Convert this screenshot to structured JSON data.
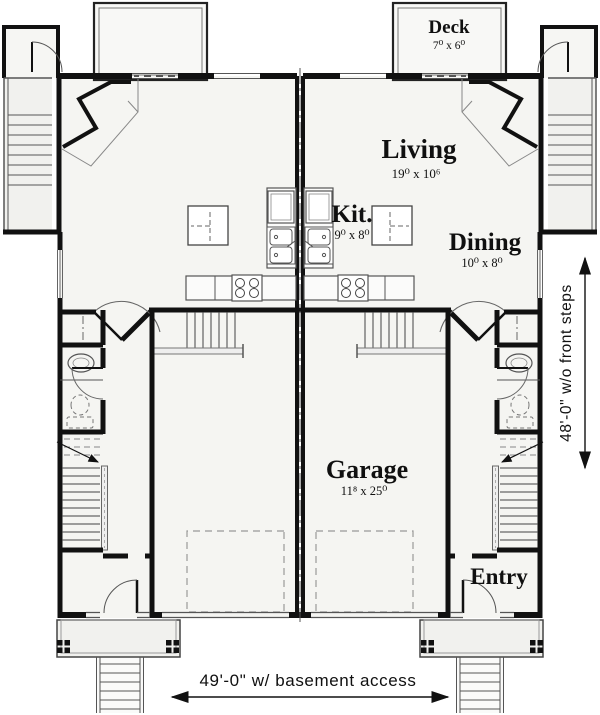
{
  "plan": {
    "rooms": {
      "deck": {
        "name": "Deck",
        "dims": "7⁰ x 6⁰"
      },
      "living": {
        "name": "Living",
        "dims": "19⁰ x 10⁶"
      },
      "kitchen": {
        "name": "Kit.",
        "dims": "9⁰ x 8⁰"
      },
      "dining": {
        "name": "Dining",
        "dims": "10⁰ x 8⁰"
      },
      "garage": {
        "name": "Garage",
        "dims": "11⁸ x 25⁰"
      },
      "entry": {
        "name": "Entry"
      }
    },
    "annotations": {
      "width_dim": "49'-0\" w/ basement access",
      "height_dim": "48'-0\" w/o front steps"
    },
    "colors": {
      "wall": "#111111",
      "fixture": "#666666",
      "floor": "#f5f5f2",
      "dashed": "#999999"
    }
  }
}
